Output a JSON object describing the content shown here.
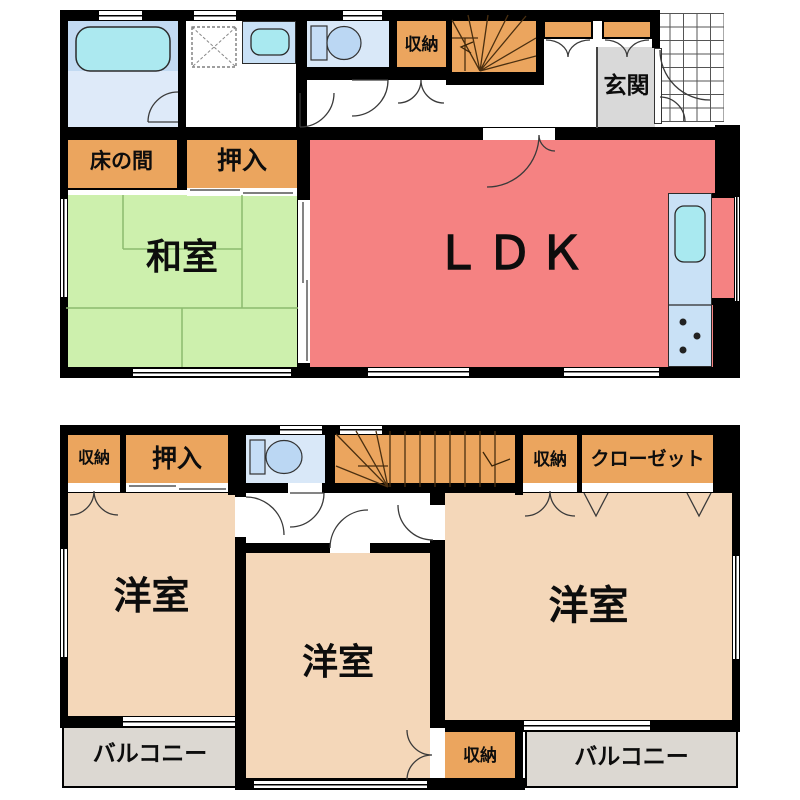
{
  "labels": {
    "f1_shuno": "収納",
    "f1_genkan": "玄関",
    "f1_tokonoma": "床の間",
    "f1_oshiire": "押入",
    "f1_washitsu": "和室",
    "f1_ldk": "ＬＤＫ",
    "f2_shuno_topleft": "収納",
    "f2_oshiire": "押入",
    "f2_shuno_topright": "収納",
    "f2_closet": "クローゼット",
    "f2_yoshitsu_left": "洋室",
    "f2_yoshitsu_middle": "洋室",
    "f2_yoshitsu_right": "洋室",
    "f2_shuno_bottom": "収納",
    "f2_balcony_left": "バルコニー",
    "f2_balcony_right": "バルコニー"
  },
  "colors": {
    "wall": "#000000",
    "ldk_red": "#F58282",
    "washitsu_green": "#CDF0AD",
    "storage_orange": "#EBA55E",
    "western_room_peach": "#F4D7B9",
    "bath_blue_dark": "#C2DAF2",
    "bath_blue_light": "#DEEAF9",
    "toilet_room_blue": "#D9E8F8",
    "fixture_cyan": "#A9E9F0",
    "counter_blue": "#C9E1F6",
    "genkan_gray": "#D9D9D9",
    "balcony_gray": "#DCD8D2"
  },
  "icons": [
    "bathtub-icon",
    "washing-machine-icon",
    "washbasin-icon",
    "toilet-icon",
    "stairs-icon",
    "kitchen-sink-icon",
    "stove-burners-icon",
    "entrance-tiles-icon",
    "door-swing-icon",
    "sliding-door-icon",
    "folding-door-icon",
    "window-icon"
  ]
}
